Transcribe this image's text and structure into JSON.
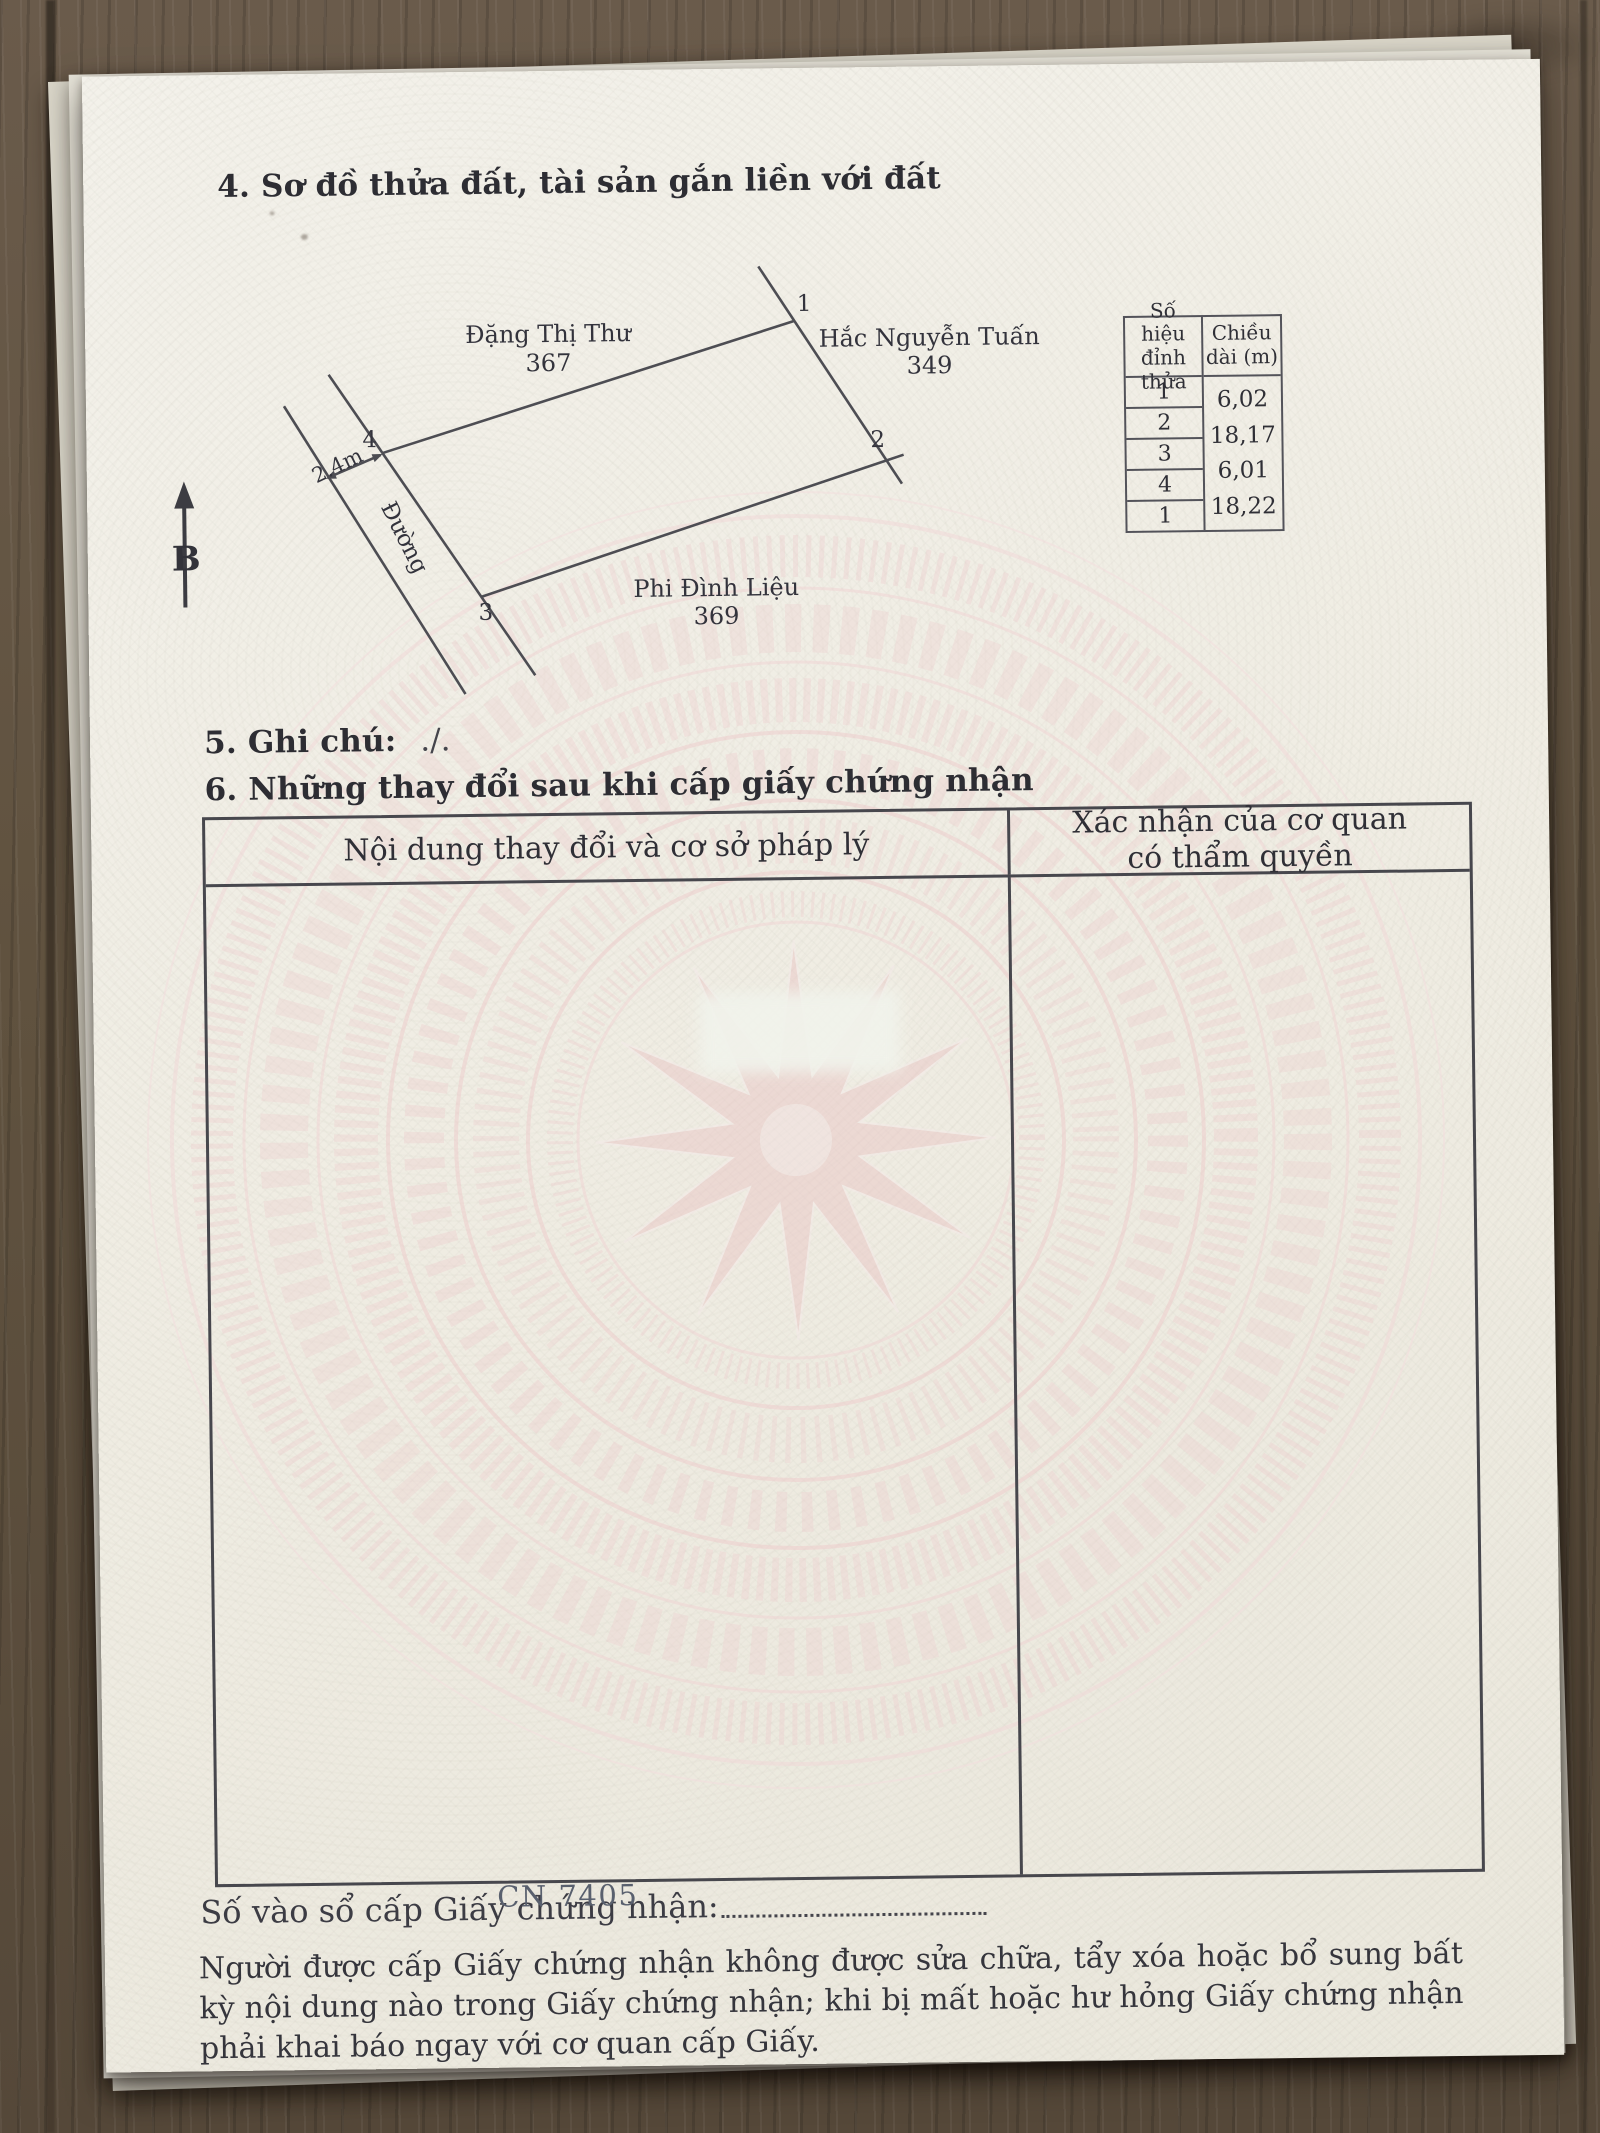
{
  "colors": {
    "wood": "#5f5245",
    "paper": "#f1efe6",
    "ink": "#2d2d33",
    "watermark_pink": "#ecc9c9"
  },
  "document": {
    "section4": {
      "title": "4. Sơ đồ thửa đất, tài sản gắn liền với đất"
    },
    "diagram": {
      "north_label": "B",
      "road_label": "Đường",
      "road_width_label": "2.4m",
      "neighbor_top": {
        "name": "Đặng Thị Thư",
        "parcel_no": "367"
      },
      "neighbor_right": {
        "name": "Hắc Nguyễn Tuấn",
        "parcel_no": "349"
      },
      "neighbor_bottom": {
        "name": "Phi Đình Liệu",
        "parcel_no": "369"
      },
      "vertex_labels": {
        "v1": "1",
        "v2": "2",
        "v3": "3",
        "v4": "4"
      },
      "measure_table": {
        "col1_header_line1": "Số hiệu",
        "col1_header_line2": "đỉnh thửa",
        "col2_header_line1": "Chiều",
        "col2_header_line2": "dài (m)",
        "vertex_rows": [
          "1",
          "2",
          "3",
          "4",
          "1"
        ],
        "length_values": [
          "6,02",
          "18,17",
          "6,01",
          "18,22"
        ]
      }
    },
    "section5": {
      "label": "5. Ghi chú:",
      "value": "./."
    },
    "section6": {
      "title": "6. Những thay đổi sau khi cấp giấy chứng nhận",
      "table": {
        "col1_header": "Nội dung thay đổi và cơ sở pháp lý",
        "col2_header_line1": "Xác nhận của cơ quan",
        "col2_header_line2": "có thẩm quyền"
      }
    },
    "registry": {
      "label": "Số vào sổ cấp Giấy chứng nhận:",
      "number": "CN 7405"
    },
    "notice": "Người được cấp Giấy chứng nhận không được sửa chữa, tẩy xóa hoặc bổ sung bất kỳ nội dung nào trong Giấy chứng nhận; khi bị mất hoặc hư hỏng Giấy chứng nhận phải khai báo ngay với cơ quan cấp Giấy."
  }
}
